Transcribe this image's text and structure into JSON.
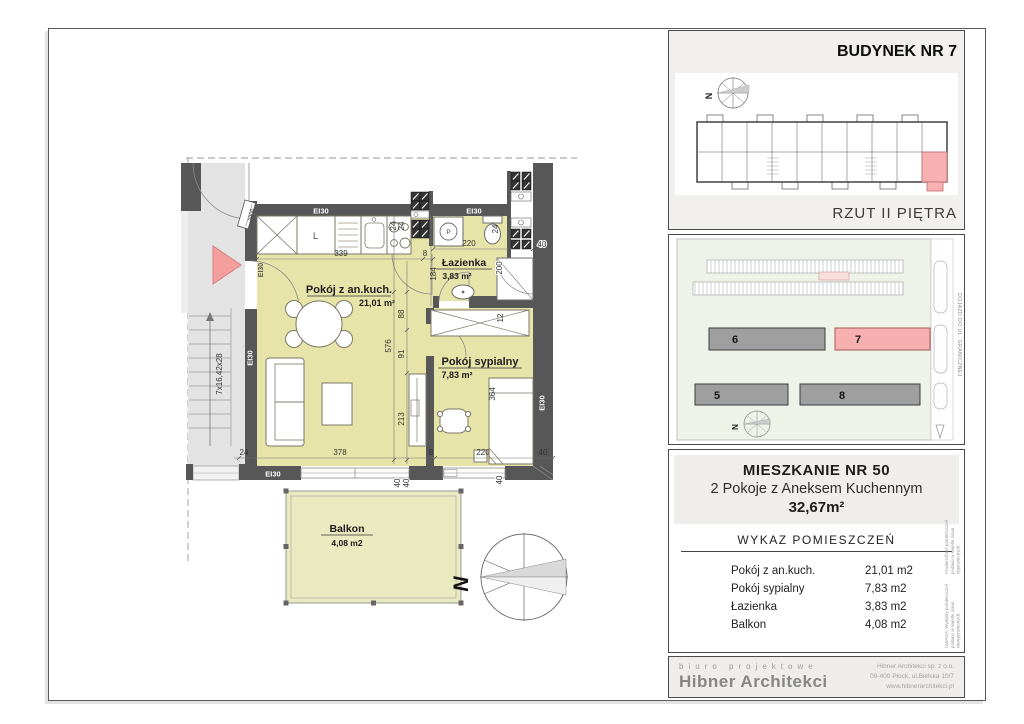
{
  "floor_plan": {
    "rooms": {
      "living": {
        "name": "Pokój z an.kuch.",
        "area": "21,01 m²"
      },
      "bedroom": {
        "name": "Pokój sypialny",
        "area": "7,83 m²"
      },
      "bath": {
        "name": "Łazienka",
        "area": "3,83 m²"
      },
      "balcony": {
        "name": "Balkon",
        "area": "4,08 m2"
      }
    },
    "labels": {
      "ei30": "EI30",
      "sanit": "sanit",
      "stairs": "7x16,42x28",
      "north": "N",
      "cabinet_l": "L",
      "washer_p": "P"
    },
    "dims": {
      "v339": "339",
      "v378": "378",
      "v220": "220",
      "v213": "213",
      "v200": "200",
      "v184": "184",
      "v364": "364",
      "v576": "576",
      "v91": "91",
      "v88": "88",
      "v40": "40",
      "v24": "24",
      "v12": "12",
      "v8": "8"
    }
  },
  "building_panel": {
    "title": "BUDYNEK NR 7",
    "subtitle": "RZUT II PIĘTRA",
    "north": "N"
  },
  "site_panel": {
    "buildings": {
      "b5": "5",
      "b6": "6",
      "b7": "7",
      "b8": "8"
    },
    "road_label": "DOJAZD DO UL. GRANICZNEJ",
    "north": "N"
  },
  "apartment_panel": {
    "title": "MIESZKANIE NR 50",
    "subtitle": "2 Pokoje z Aneksem Kuchennym",
    "total_area": "32,67m²",
    "table_title": "WYKAZ POMIESZCZEŃ",
    "rows": [
      {
        "label": "Pokój z an.kuch.",
        "value": "21,01 m2"
      },
      {
        "label": "Pokój sypialny",
        "value": "7,83 m2"
      },
      {
        "label": "Łazienka",
        "value": "3,83 m2"
      },
      {
        "label": "Balkon",
        "value": "4,08 m2"
      }
    ],
    "note_line1": "UWAGA: Wymiary pomieszczeń podano w świetle ścian niewyprawionych.",
    "note_line2": "Powierzchnie pomieszczeń podano w świetle ścian wyprawionych."
  },
  "footer": {
    "tagline": "biuro projektowe",
    "company": "Hibner Architekci",
    "address_line1": "Hibner Architekci sp. z o.o.",
    "address_line2": "09-400 Płock, ul.Bielska 10/7",
    "address_line3": "www.hibnerarchitekci.pl"
  }
}
